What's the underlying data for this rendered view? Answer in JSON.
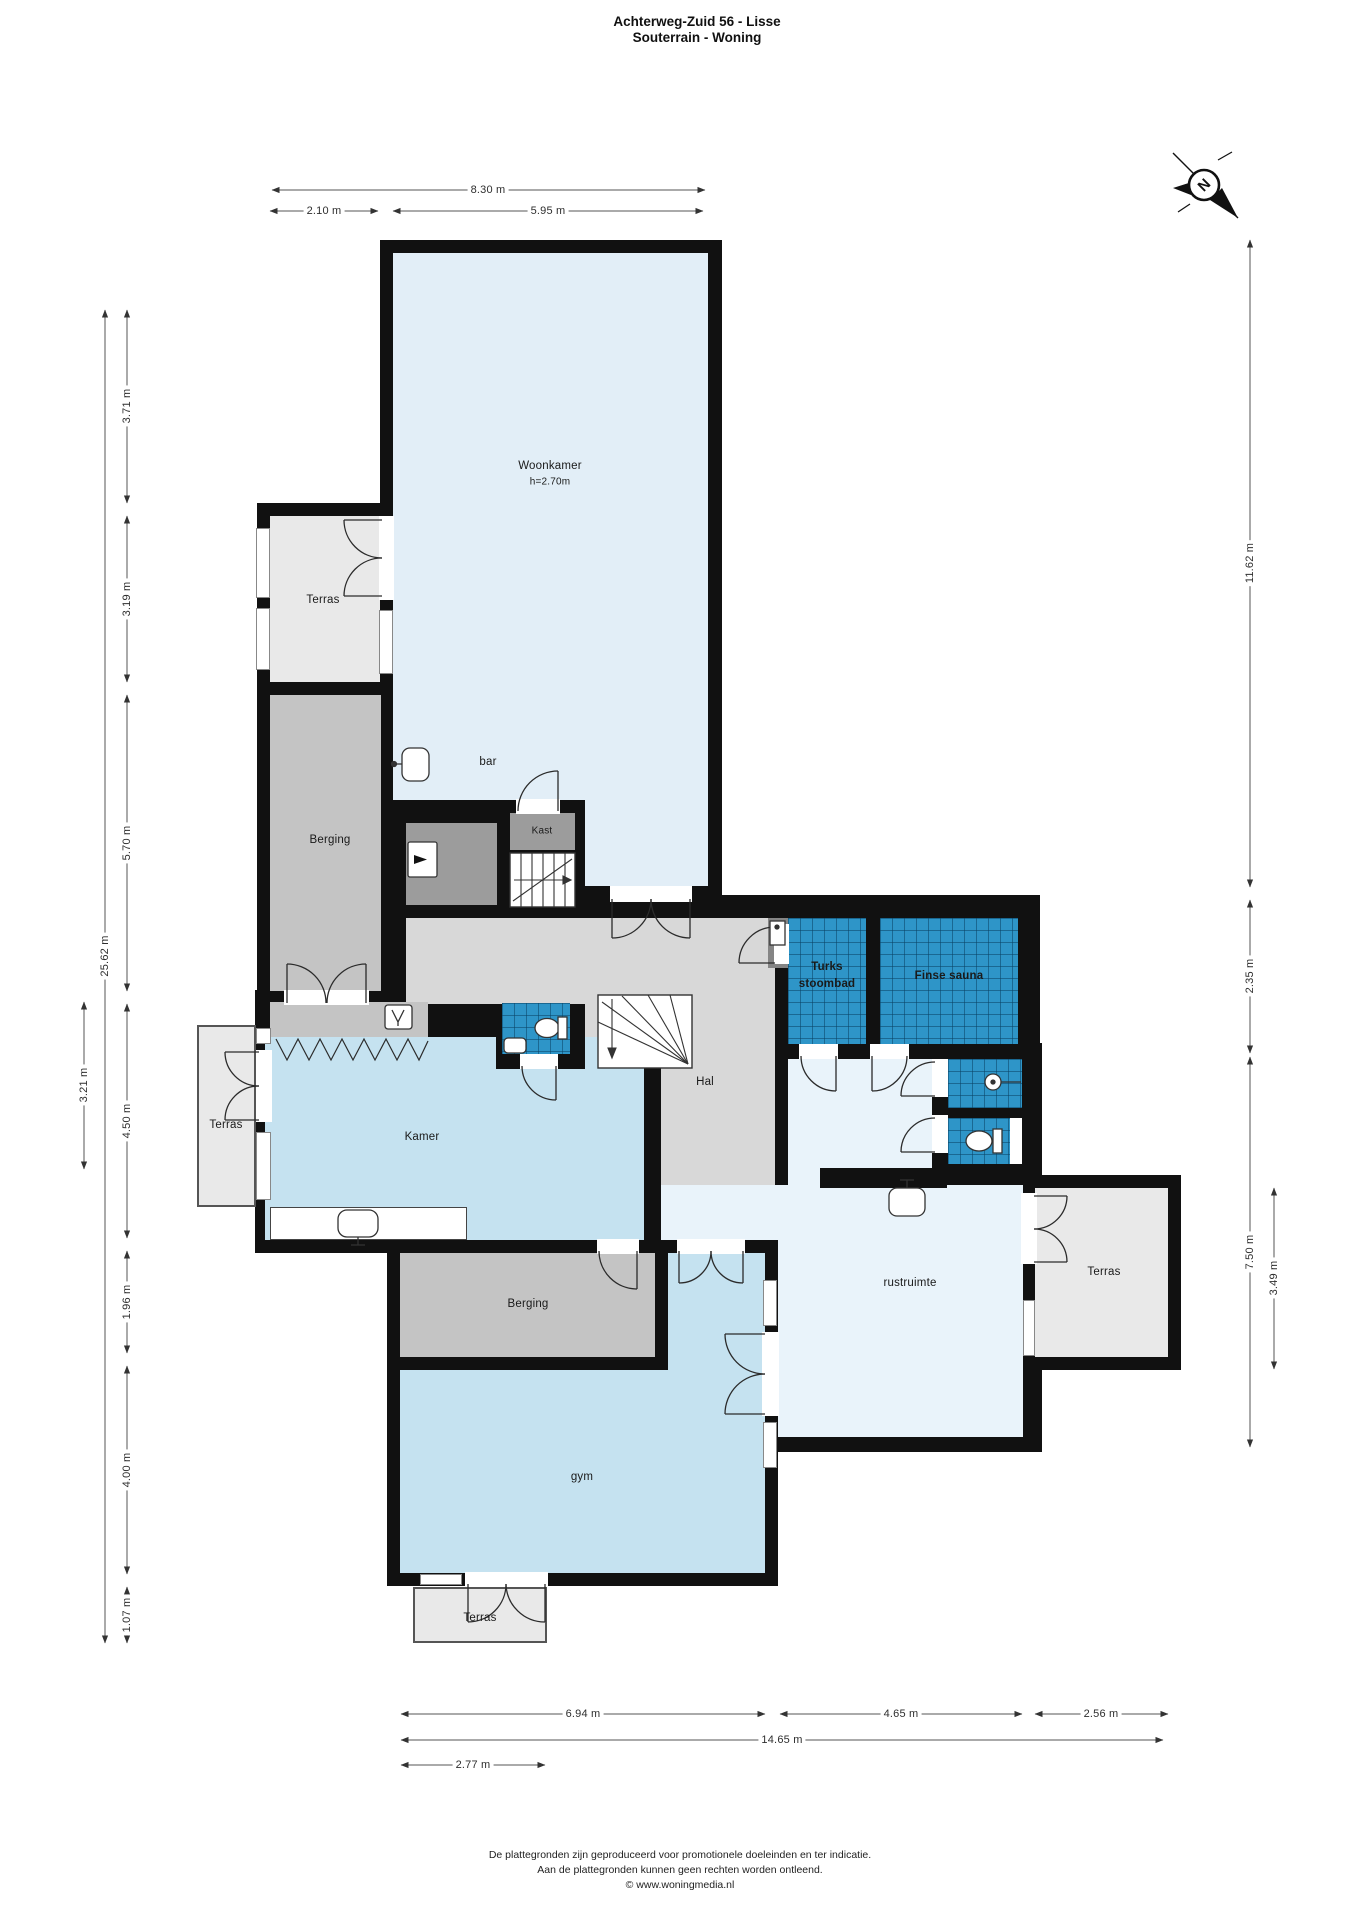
{
  "title": {
    "line1": "Achterweg-Zuid 56 - Lisse",
    "line2": "Souterrain - Woning"
  },
  "compass": {
    "label": "N"
  },
  "rooms": {
    "woonkamer": {
      "name": "Woonkamer",
      "note": "h=2.70m"
    },
    "terras1": {
      "name": "Terras"
    },
    "berging1": {
      "name": "Berging"
    },
    "bar": {
      "name": "bar"
    },
    "kast": {
      "name": "Kast"
    },
    "kamer": {
      "name": "Kamer"
    },
    "terras2": {
      "name": "Terras"
    },
    "hal": {
      "name": "Hal"
    },
    "turks": {
      "name_line1": "Turks",
      "name_line2": "stoombad"
    },
    "finse": {
      "name": "Finse sauna"
    },
    "rustruimte": {
      "name": "rustruimte"
    },
    "terras3": {
      "name": "Terras"
    },
    "berging2": {
      "name": "Berging"
    },
    "gym": {
      "name": "gym"
    },
    "terras4": {
      "name": "Terras"
    }
  },
  "dimensions": {
    "top": [
      {
        "label": "8.30 m"
      },
      {
        "label": "2.10 m"
      },
      {
        "label": "5.95 m"
      }
    ],
    "left": [
      {
        "label": "25.62 m"
      },
      {
        "label": "3.71 m"
      },
      {
        "label": "3.19 m"
      },
      {
        "label": "5.70 m"
      },
      {
        "label": "4.50 m"
      },
      {
        "label": "1.96 m"
      },
      {
        "label": "4.00 m"
      },
      {
        "label": "1.07 m"
      },
      {
        "label": "3.21 m"
      }
    ],
    "right": [
      {
        "label": "11.62 m"
      },
      {
        "label": "2.35 m"
      },
      {
        "label": "7.50 m"
      },
      {
        "label": "3.49 m"
      }
    ],
    "bottom": [
      {
        "label": "6.94 m"
      },
      {
        "label": "4.65 m"
      },
      {
        "label": "2.56 m"
      },
      {
        "label": "14.65 m"
      },
      {
        "label": "2.77 m"
      }
    ]
  },
  "footer": {
    "line1": "De plattegronden zijn geproduceerd voor promotionele doeleinden en ter indicatie.",
    "line2": "Aan de plattegronden kunnen geen rechten worden ontleend.",
    "line3": "© www.woningmedia.nl"
  },
  "colors": {
    "wall": "#111111",
    "living_light_blue": "#e2eef7",
    "room_blue": "#c5e2f0",
    "rest_pale_blue": "#e9f3fa",
    "tile_blue": "#2e95c8",
    "terrace_gray": "#e9e9e9",
    "storage_gray": "#c4c4c4",
    "tech_dark_gray": "#9c9c9c",
    "hall_gray": "#d8d8d8"
  }
}
